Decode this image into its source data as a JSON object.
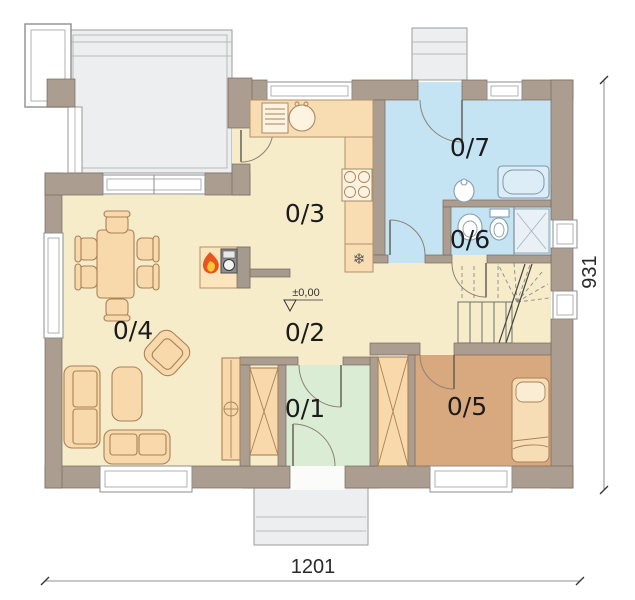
{
  "rooms": [
    {
      "id": "room-0-1",
      "label": "0/1",
      "floor_color": "#daecd4"
    },
    {
      "id": "room-0-2",
      "label": "0/2",
      "floor_color": "#f6ecca"
    },
    {
      "id": "room-0-3",
      "label": "0/3",
      "floor_color": "#f6ecca"
    },
    {
      "id": "room-0-4",
      "label": "0/4",
      "floor_color": "#f6ecca"
    },
    {
      "id": "room-0-5",
      "label": "0/5",
      "floor_color": "#d8a87e"
    },
    {
      "id": "room-0-6",
      "label": "0/6",
      "floor_color": "#c5e4f3"
    },
    {
      "id": "room-0-7",
      "label": "0/7",
      "floor_color": "#c5e4f3"
    }
  ],
  "dimensions": {
    "width_label": "1201",
    "depth_label": "931"
  },
  "elevation_label": "±0,00",
  "icons": {
    "fridge_glyph": "❄",
    "fireplace": "flame-icon"
  },
  "colors": {
    "wall": "#ab9e90",
    "floor_main": "#f6ecca",
    "floor_wet": "#c5e4f3",
    "floor_entry": "#daecd4",
    "floor_bedroom": "#d8a87e",
    "terrace": "#edeef0",
    "furniture": "#f7d9ab",
    "counter": "#f8dcb2"
  }
}
